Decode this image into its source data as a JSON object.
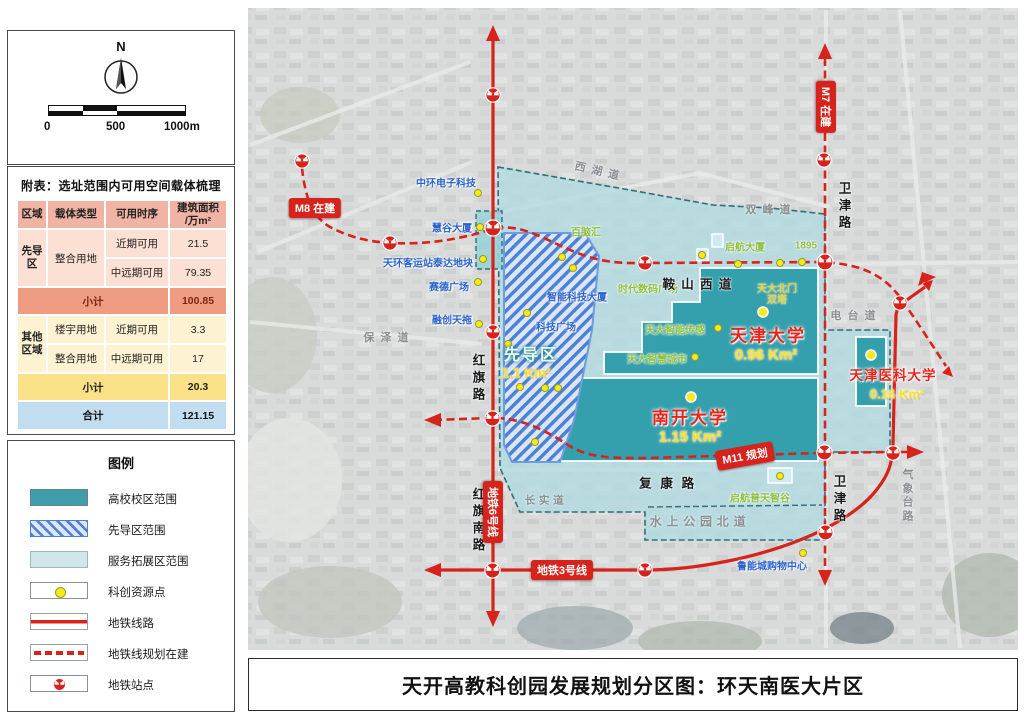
{
  "sidebar": {
    "compass": {
      "north_label": "N"
    },
    "scale": {
      "ticks": [
        "0",
        "500",
        "1000m"
      ]
    },
    "table": {
      "title": "附表：选址范围内可用空间载体梳理",
      "headers": [
        "区域",
        "载体类型",
        "可用时序",
        "建筑面积\n/万m²"
      ],
      "zone1": "先导区",
      "zone1_carrier": "整合用地",
      "r1_timing": "近期可用",
      "r1_value": "21.5",
      "r2_timing": "中远期可用",
      "r2_value": "79.35",
      "sub1_label": "小计",
      "sub1_value": "100.85",
      "zone2": "其他区域",
      "r3_carrier": "楼宇用地",
      "r3_timing": "近期可用",
      "r3_value": "3.3",
      "r4_carrier": "整合用地",
      "r4_timing": "中远期可用",
      "r4_value": "17",
      "sub2_label": "小计",
      "sub2_value": "20.3",
      "total_label": "合计",
      "total_value": "121.15"
    },
    "legend": {
      "title": "图例",
      "items": [
        "高校校区范围",
        "先导区范围",
        "服务拓展区范围",
        "科创资源点",
        "地铁线路",
        "地铁线规划在建",
        "地铁站点"
      ]
    }
  },
  "map": {
    "colors": {
      "campus": "#3f9dab",
      "service": "#b2dbe0",
      "pilot_stripe": "#4d7fd2",
      "metro_red": "#d6231c",
      "resource_dot": "#f6ea1c"
    },
    "universities": {
      "tju": "天津大学",
      "tju_area": "0.96 Km²",
      "nku": "南开大学",
      "nku_area": "1.15 Km²",
      "tmu": "天津医科大学",
      "tmu_area": "0.16 Km²",
      "pilot": "先导区",
      "pilot_area": "1.1 Km²"
    },
    "poi_blue": {
      "zhonghuan": "中环电子科技",
      "huigu": "慧谷大厦",
      "tianhuan": "天环客运站泰达地块",
      "saide": "赛德广场",
      "rongchuang": "融创天拖",
      "zhineng": "智能科技大厦",
      "keji": "科技广场",
      "luneng": "鲁能城购物中心"
    },
    "poi_green": {
      "bainaohui": "百脑汇",
      "qihang": "启航大厦",
      "y1895": "1895",
      "shidai": "时代数码广场",
      "chuangan": "天大智能传感",
      "zhihui": "天大智慧城市",
      "putian": "启航普天智谷",
      "beimen": "天大北门",
      "beimen2": "双塔"
    },
    "roads": {
      "xihu": "西湖道",
      "shuangfeng": "双峰道",
      "baoze": "保泽道",
      "changshi": "长实道",
      "shuishang": "水上公园北道",
      "diantai": "电台道",
      "qixiangtai": "气象台路",
      "anshan": "鞍山西道",
      "fukang": "复康路",
      "weijin_n": "卫津路",
      "weijin_s": "卫津路",
      "hongqi": "红旗路",
      "hongqinan": "红旗南路"
    },
    "badges": {
      "m8": "M8 在建",
      "m7": "M7 在建",
      "m11": "M11 规划",
      "line3": "地铁3号线",
      "line6": "地铁6号线"
    }
  },
  "footer": {
    "title": "天开高教科创园发展规划分区图：环天南医大片区"
  }
}
